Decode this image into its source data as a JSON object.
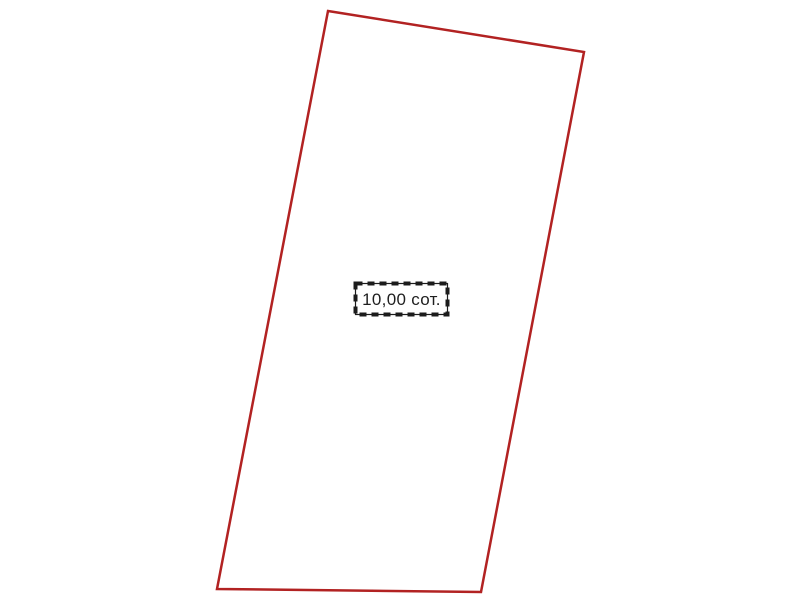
{
  "page": {
    "background_color": "#ffffff",
    "width": 800,
    "height": 600
  },
  "parcel": {
    "outline_color": "#b22222",
    "outline_width": "2.5",
    "points_attr": "328,11 584,52 481,592 217,589",
    "fill": "none"
  },
  "label": {
    "area_text": "10,00 сот.",
    "box_fill": "#ffffff",
    "border_color": "#1c1c1c",
    "dash_pattern": "7 5",
    "dash_width": "4",
    "text_color": "#1f1f1f"
  }
}
